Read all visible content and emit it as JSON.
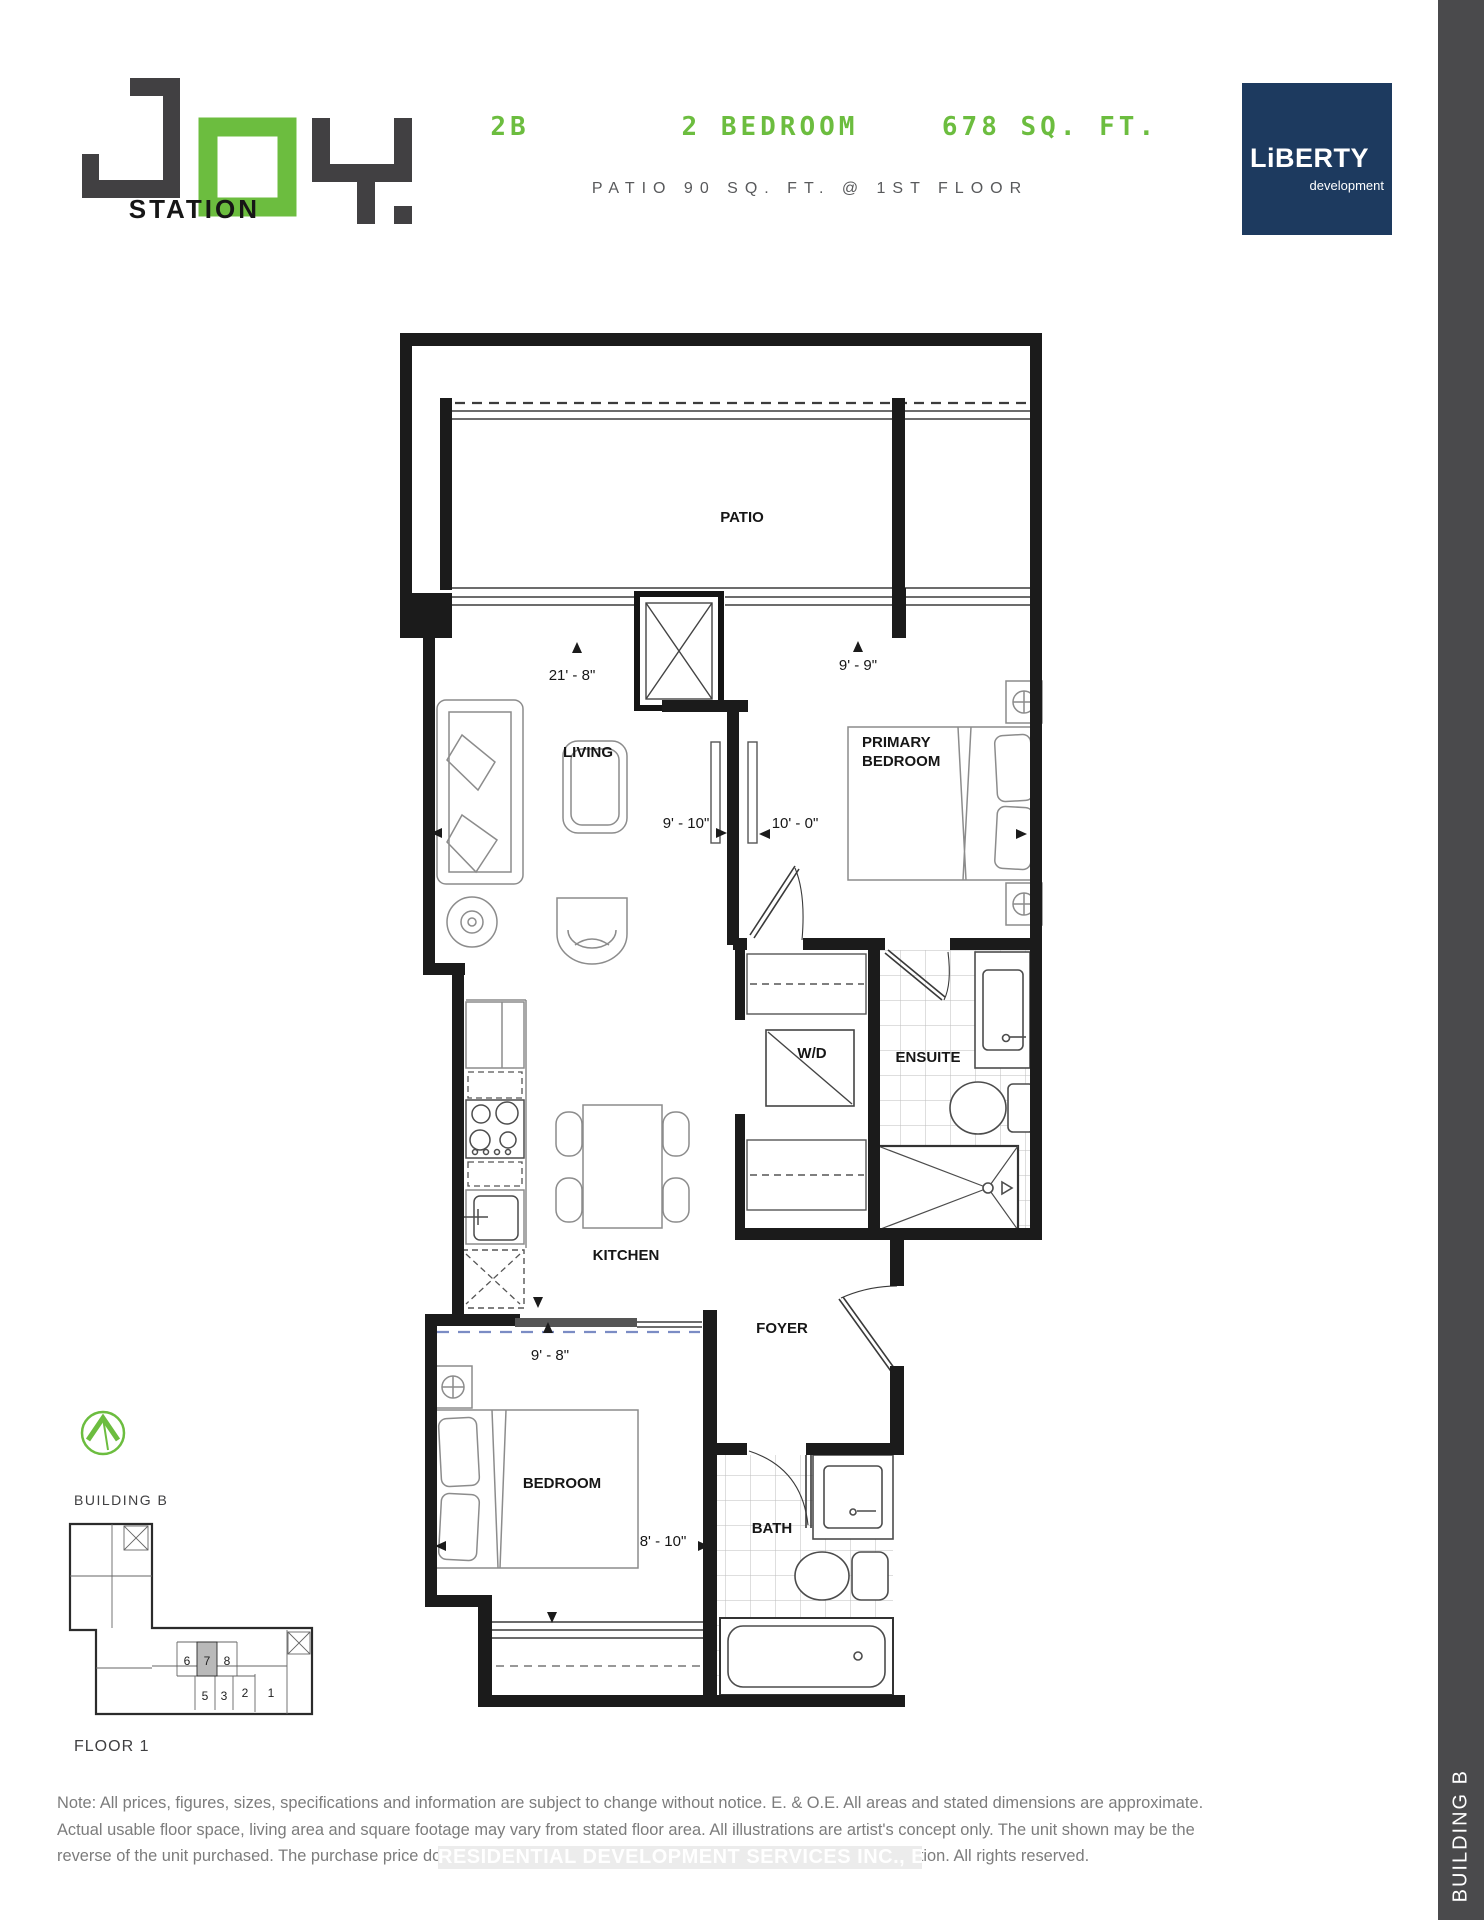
{
  "header": {
    "logo": {
      "word": "JOY",
      "sub": "STATION"
    },
    "unit_code": "2B",
    "unit_type": "2 BEDROOM",
    "unit_area": "678 SQ. FT.",
    "subtitle": "PATIO 90 SQ. FT. @ 1ST FLOOR",
    "brand": {
      "name": "LiBERTY",
      "tagline": "development"
    }
  },
  "colors": {
    "green": "#6cbd3f",
    "dark": "#414042",
    "navy": "#1d3a5f"
  },
  "plan": {
    "rooms": {
      "patio": "PATIO",
      "living": "LIVING",
      "primary1": "PRIMARY",
      "primary2": "BEDROOM",
      "ensuite": "ENSUITE",
      "wd": "W/D",
      "kitchen": "KITCHEN",
      "foyer": "FOYER",
      "bedroom": "BEDROOM",
      "bath": "BATH"
    },
    "dims": {
      "living_depth": "21' - 8\"",
      "living_width": "9' - 10\"",
      "primary_window": "9' - 9\"",
      "primary_width": "10' - 0\"",
      "bedroom_window": "9' - 8\"",
      "bedroom_width": "8' - 10\""
    }
  },
  "keyplan": {
    "building": "BUILDING B",
    "floor": "FLOOR 1",
    "units": [
      {
        "label": "6"
      },
      {
        "label": "7",
        "highlighted": true
      },
      {
        "label": "8"
      },
      {
        "label": "5"
      },
      {
        "label": "3"
      },
      {
        "label": "2"
      },
      {
        "label": "1"
      }
    ]
  },
  "sidebar": {
    "label": "BUILDING B"
  },
  "footer": {
    "note1": "Note:  All prices, figures, sizes, specifications and information are subject to change without notice.  E. & O.E.  All areas and stated dimensions are approximate.",
    "note2": "Actual usable floor space, living area and square footage may vary from stated floor area.  All illustrations are artist's concept only.  The unit shown may be the",
    "note3": "reverse of the unit purchased. The purchase price does not include any furniture. © 2023 Liberty Development Corporation. All rights reserved.",
    "watermark": "RESIDENTIAL DEVELOPMENT SERVICES INC., Brokerage"
  }
}
